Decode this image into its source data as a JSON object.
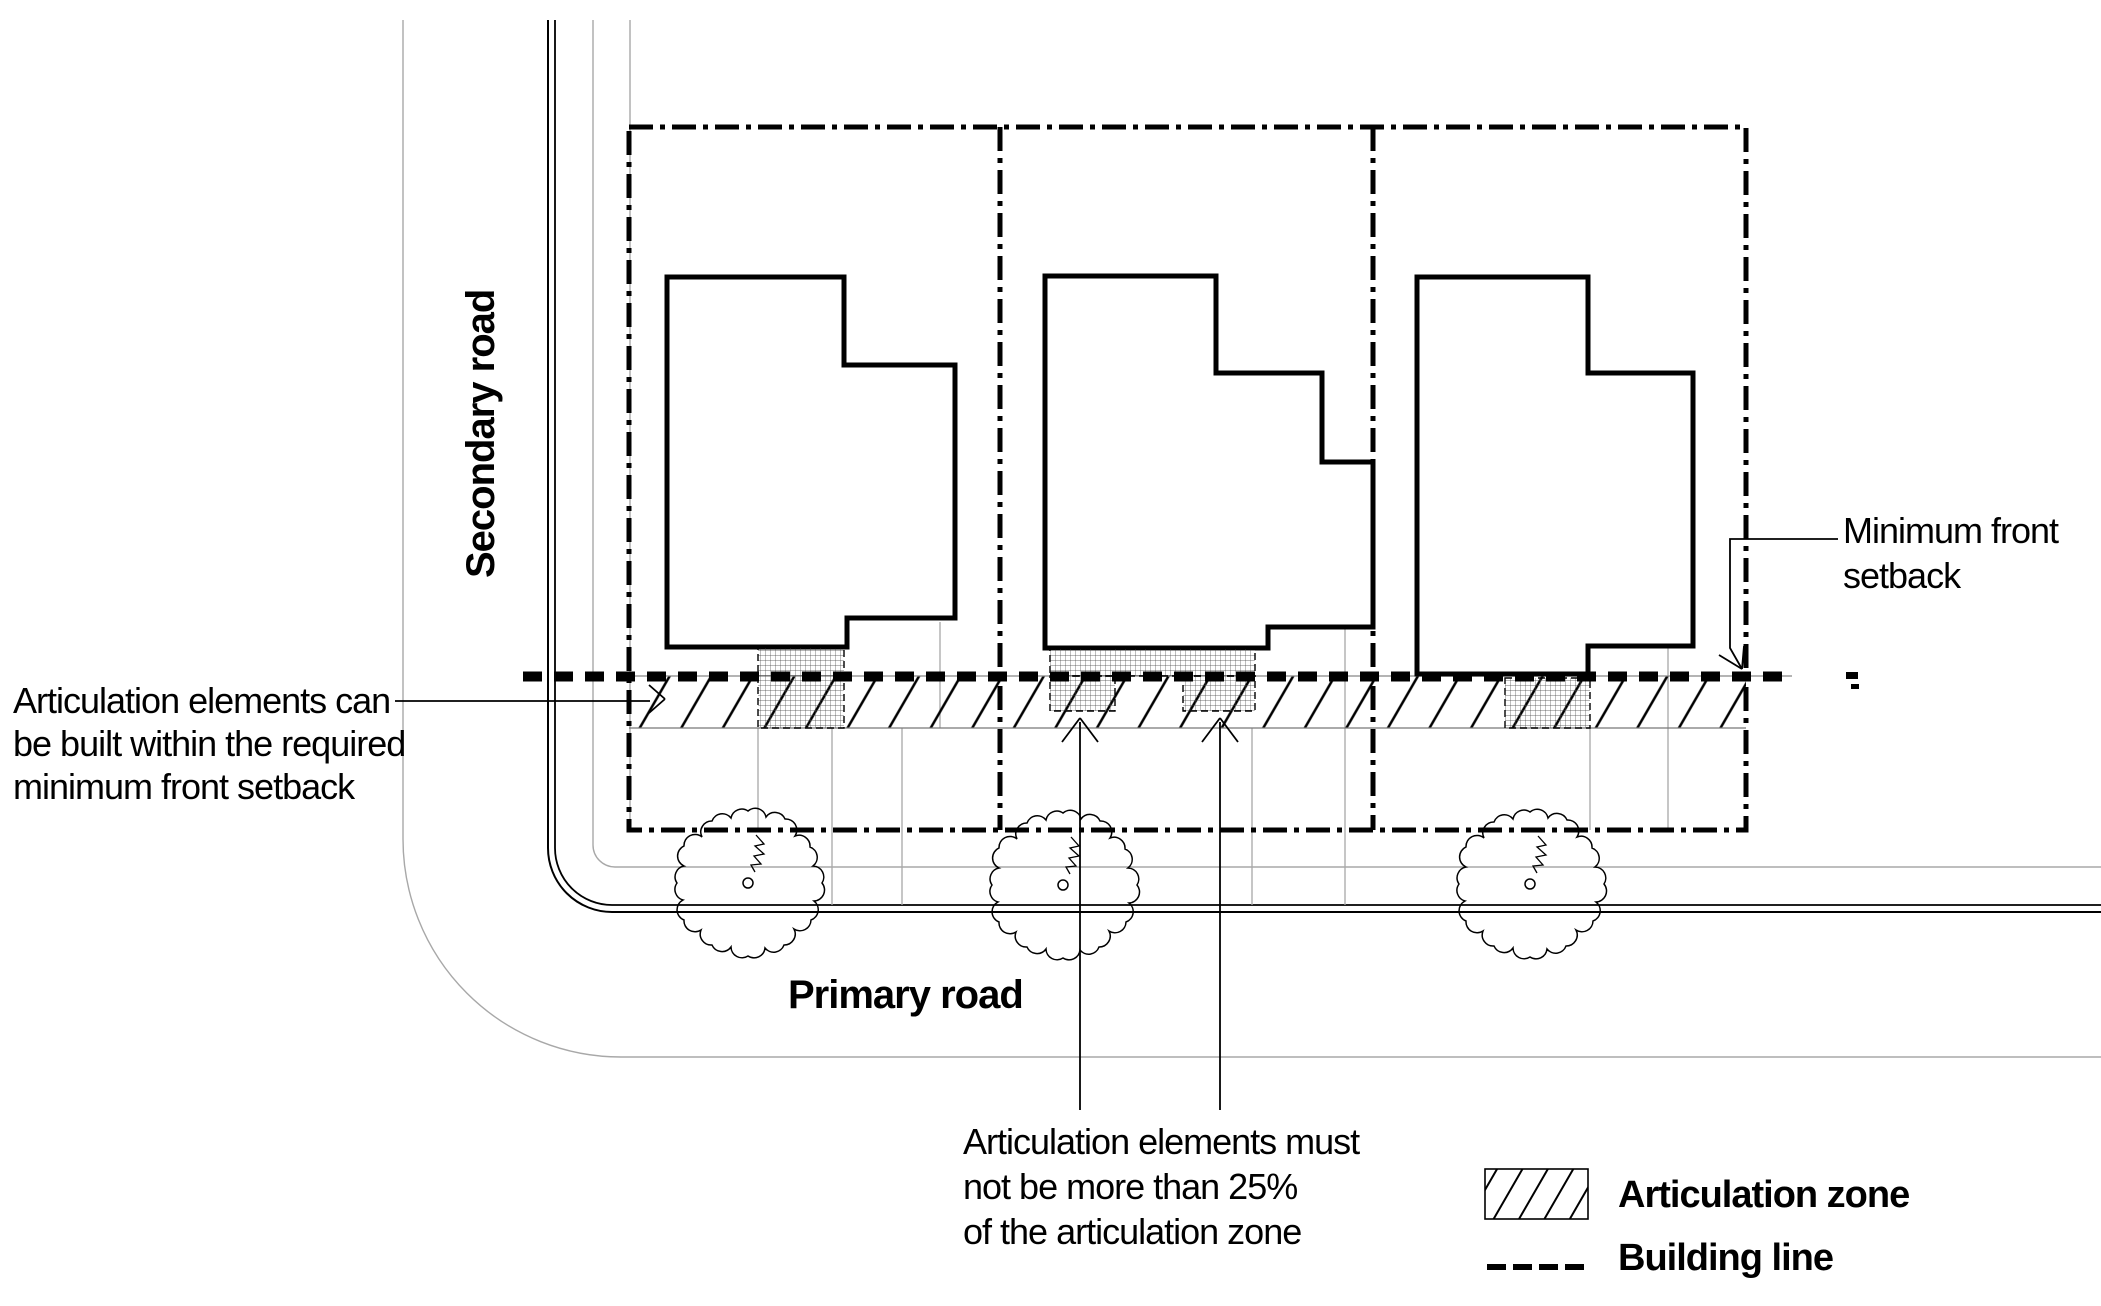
{
  "page": {
    "background": "#ffffff",
    "ink_color": "#000000",
    "gray_line_color": "#a8a8a8"
  },
  "roads": {
    "secondary_label": "Secondary road",
    "primary_label": "Primary road"
  },
  "annotations": {
    "articulation_note": {
      "lines": [
        "Articulation elements can",
        "be built within the required",
        "minimum front setback"
      ]
    },
    "setback_note": {
      "lines": [
        "Minimum front",
        "setback"
      ]
    },
    "articulation_limit_note": {
      "lines": [
        "Articulation elements must",
        "not be more than 25%",
        "of the articulation zone"
      ]
    }
  },
  "legend": {
    "items": [
      {
        "id": "articulation-zone",
        "symbol": "hatched-rect",
        "label": "Articulation zone"
      },
      {
        "id": "building-line",
        "symbol": "dashed-line",
        "label": "Building line"
      }
    ]
  }
}
